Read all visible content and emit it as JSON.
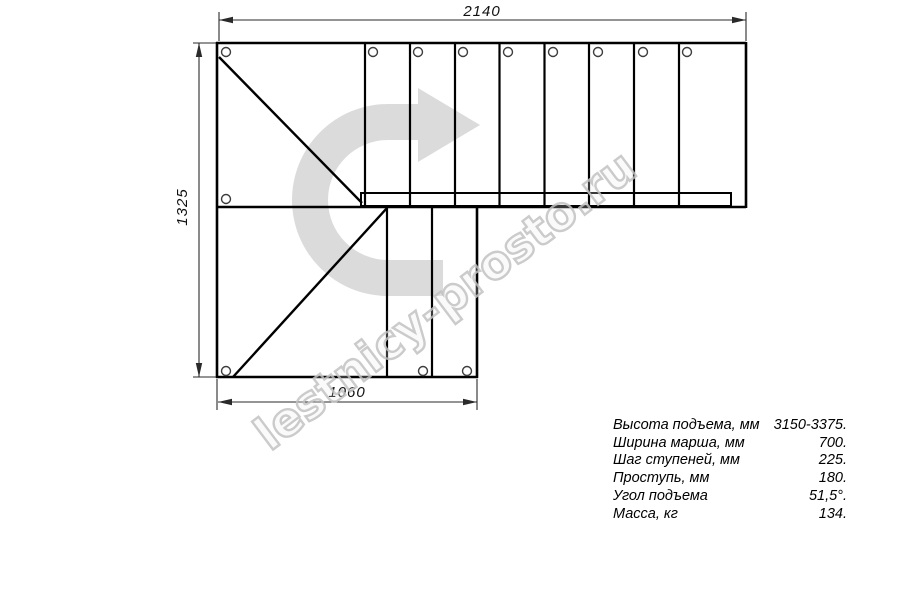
{
  "drawing": {
    "type": "l-shaped-staircase-plan",
    "line_color": "#000000",
    "dim_line_color": "#2a2a2a",
    "watermark_fill": "#d7d7d7",
    "watermark_stroke": "#c2c2c2"
  },
  "dimensions": {
    "top_width": "2140",
    "left_height": "1325",
    "bottom_width": "1060"
  },
  "watermark": {
    "text": "lestnicy-prosto.ru",
    "arrow_icon": "u-turn-right-arrow-icon"
  },
  "specs": {
    "rows": [
      {
        "label": "Высота подъема, мм",
        "value": "3150-3375."
      },
      {
        "label": "Ширина марша, мм",
        "value": "700."
      },
      {
        "label": "Шаг ступеней, мм",
        "value": "225."
      },
      {
        "label": "Проступь, мм",
        "value": "180."
      },
      {
        "label": "Угол подъема",
        "value": "51,5°."
      },
      {
        "label": "Масса, кг",
        "value": "134."
      }
    ]
  }
}
